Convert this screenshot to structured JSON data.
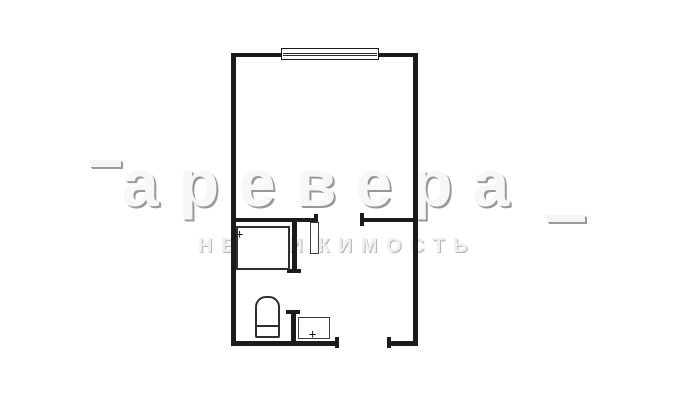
{
  "watermark": {
    "brand": "аревера",
    "tagline": "НЕДВИЖИМОСТЬ",
    "fill_color": "#f7f7f7",
    "shadow_color": "#989898"
  },
  "floorplan": {
    "background_color": "#ffffff",
    "wall_color": "#1b1b1b",
    "fixture_line_color": "#2f2f2f",
    "fixtures": [
      "window",
      "shower-cabin",
      "toilet",
      "sink",
      "door-leaf"
    ],
    "markers": {
      "shower": "+",
      "sink": "+"
    }
  }
}
